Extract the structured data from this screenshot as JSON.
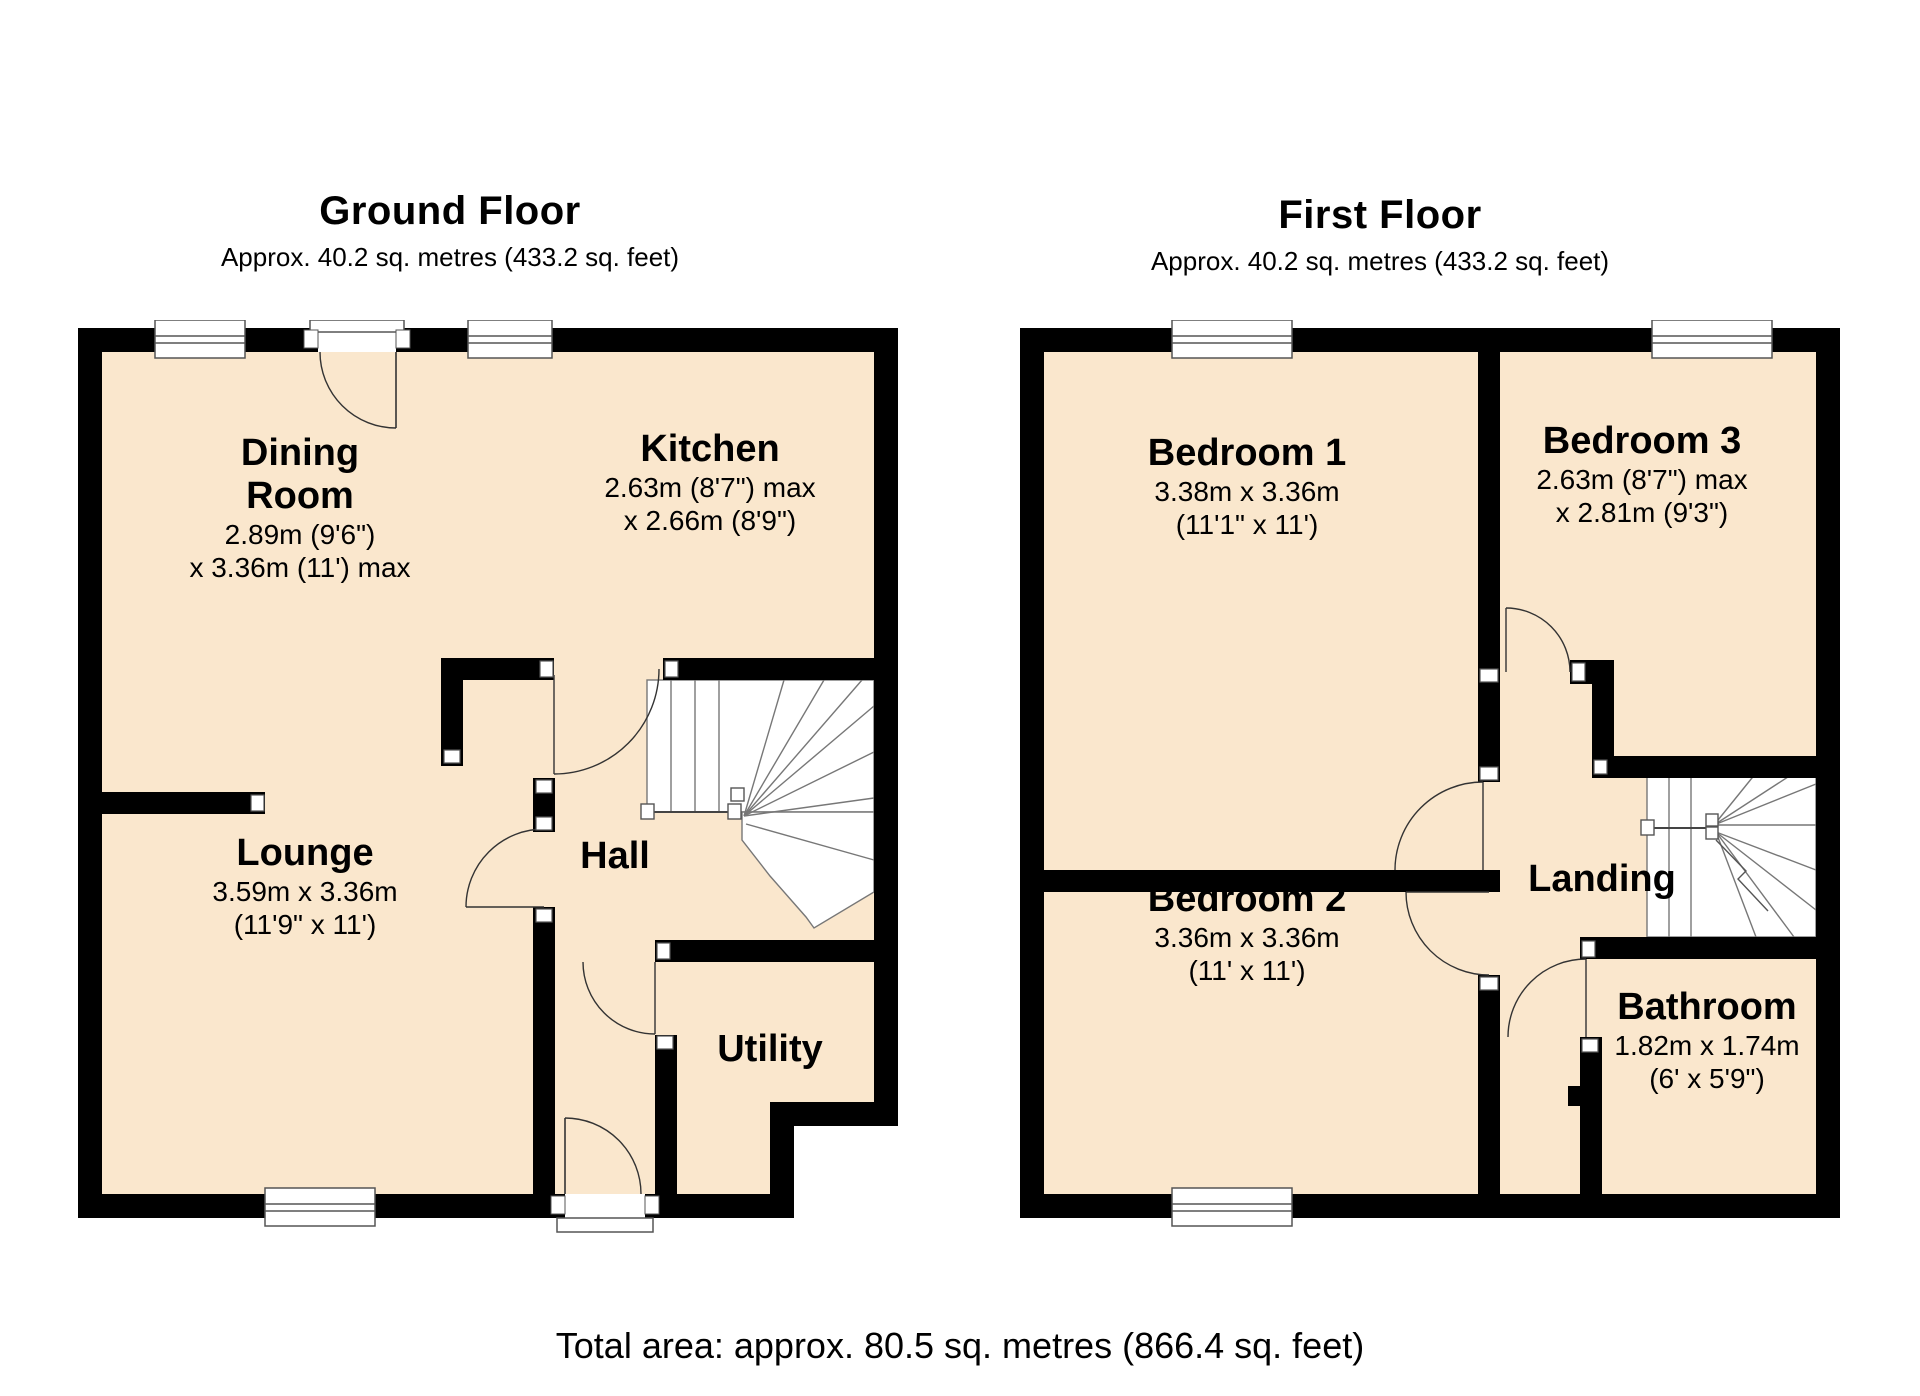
{
  "colors": {
    "background": "#ffffff",
    "floor_fill": "#FAE7CD",
    "wall": "#000000",
    "detail_line": "#555555"
  },
  "ground_floor": {
    "title": "Ground Floor",
    "subtitle": "Approx. 40.2 sq. metres (433.2 sq. feet)",
    "rooms": {
      "dining": {
        "name": "Dining",
        "name2": "Room",
        "dim1": "2.89m (9'6\")",
        "dim2": "x 3.36m (11') max"
      },
      "kitchen": {
        "name": "Kitchen",
        "dim1": "2.63m (8'7\") max",
        "dim2": "x 2.66m (8'9\")"
      },
      "lounge": {
        "name": "Lounge",
        "dim1": "3.59m x 3.36m",
        "dim2": "(11'9\" x 11')"
      },
      "hall": {
        "name": "Hall"
      },
      "utility": {
        "name": "Utility"
      }
    }
  },
  "first_floor": {
    "title": "First Floor",
    "subtitle": "Approx. 40.2 sq. metres (433.2 sq. feet)",
    "rooms": {
      "bedroom1": {
        "name": "Bedroom 1",
        "dim1": "3.38m x 3.36m",
        "dim2": "(11'1\" x 11')"
      },
      "bedroom3": {
        "name": "Bedroom 3",
        "dim1": "2.63m (8'7\") max",
        "dim2": "x 2.81m (9'3\")"
      },
      "bedroom2": {
        "name": "Bedroom 2",
        "dim1": "3.36m x 3.36m",
        "dim2": "(11' x 11')"
      },
      "landing": {
        "name": "Landing"
      },
      "bathroom": {
        "name": "Bathroom",
        "dim1": "1.82m x 1.74m",
        "dim2": "(6' x 5'9\")"
      }
    }
  },
  "total_area": "Total area: approx. 80.5 sq. metres (866.4 sq. feet)"
}
